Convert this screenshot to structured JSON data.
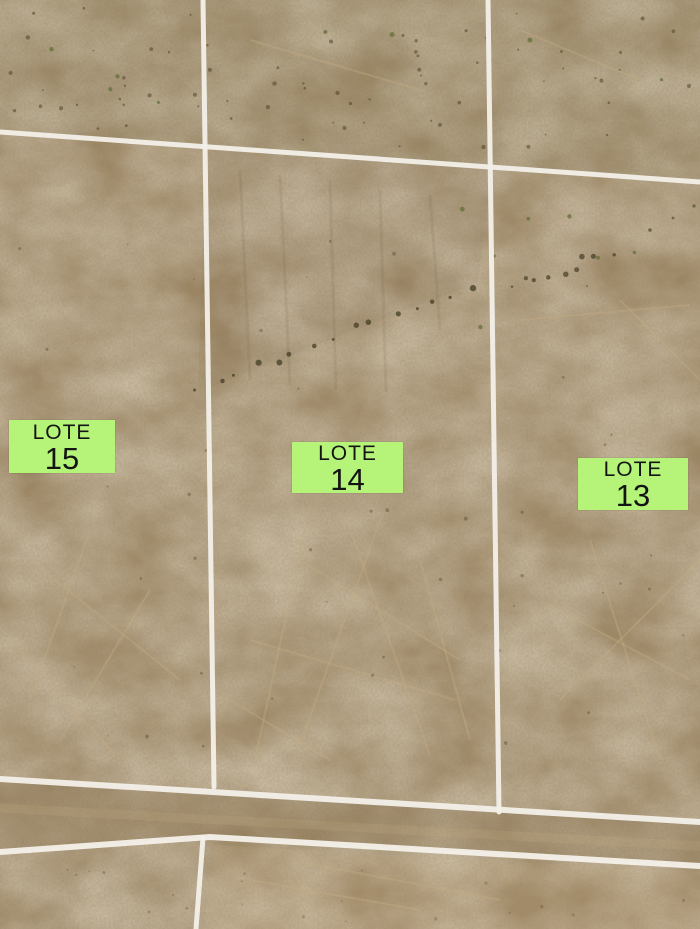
{
  "map": {
    "parcels": [
      {
        "name": "LOTE",
        "number": "15"
      },
      {
        "name": "LOTE",
        "number": "14"
      },
      {
        "name": "LOTE",
        "number": "13"
      }
    ],
    "colors": {
      "label_background": "#b5f478",
      "label_text": "#141414",
      "boundary_line": "#f4f1ea",
      "terrain_base": "#9d8662",
      "terrain_light": "#c3ab82",
      "terrain_dark": "#473a24",
      "road_tint": "#856c4b",
      "vegetation": "#5c6c33",
      "shrub": "#433d26"
    }
  }
}
